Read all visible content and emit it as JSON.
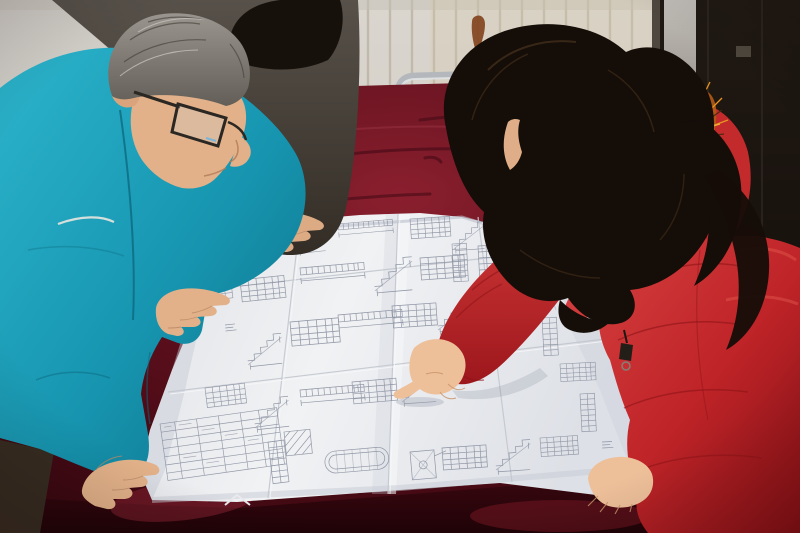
{
  "meta": {
    "type": "photograph",
    "width": 800,
    "height": 533,
    "description": "Two people review a large unfolded engineering blueprint spread over a red velvet-covered table. A middle-aged man with gray hair, dark-rimmed glasses and a bright teal work jacket leans over the drawing on the left with both hands on the sheet. A woman with long dark wavy hair, wearing a red quilted coat with an orange fur-trimmed hood, stands on the right pointing at a detail with her index finger. A third, partially visible person in a dark jacket rests one hand on the top edge of the drawing. Behind them are a ribbed cream panel wall, a dark brown door, and a metal-frame chair with a red seat."
  },
  "scene": {
    "background": {
      "wall": "ribbed cream panel wall with vertical grooves",
      "door": "dark brown door with light frame strip",
      "stain": "rust stain on wall"
    },
    "furniture": {
      "table": "table draped in dark red velvet cloth",
      "chair": "metal tube chair with red seat behind the table"
    },
    "document": {
      "blueprint": "large multi-panel structural engineering drawing with rebar schedules, stair sections, beam details, an oval section detail and visible fold creases"
    },
    "people": [
      {
        "id": "man-left",
        "description": "middle-aged man, gray hair, dark-rimmed glasses, bright teal work jacket, leaning over the drawing with both hands on it"
      },
      {
        "id": "person-behind",
        "description": "partially visible colleague in a dark jacket, black hair, one hand resting on the top edge of the drawing"
      },
      {
        "id": "woman-right",
        "description": "woman with long dark wavy hair, red quilted parka with orange fur-trimmed hood, pointing at the drawing"
      }
    ]
  },
  "colors": {
    "wall": "#d4d0c9",
    "wall_left": "#d0ccc6",
    "wall_ridge": "#b9b1a1",
    "warm_tint": "#d8c8a8",
    "door": "#16100b",
    "door_gap": "#4d473f",
    "latch": "#4e473d",
    "rust": "#7d3a12",
    "chair_red": "#a2232b",
    "chair_metal": "#b4b8bc",
    "velvet_light": "#8e2434",
    "velvet_streak_dark": "#3a0712",
    "velvet_streak_light": "#a03a4a",
    "paper_ink": "#7b8294",
    "crease": "#c3c7cf",
    "jacket_behind": "#504a42",
    "hair_behind": "#17110c",
    "teal_seam": "#0c6a80",
    "cord_white": "#e9e6df",
    "trousers": "#372c21",
    "skin_man": "#e2b189",
    "skin_behind": "#dcab83",
    "skin_woman": "#eec09a",
    "skin_shadow": "#c8946a",
    "glasses": "#2b2722",
    "hair_woman": "#150d08",
    "hair_sheen": "#50381f",
    "fur": "#b35a14",
    "fur_bright": "#e8941f",
    "fur_pale": "#f2b03a",
    "fur_dark": "#452a0e",
    "hood": "#c22a2c",
    "coat_seam": "#8e1418",
    "coat_highlight": "#ef6a5a",
    "zipper": "#241e18",
    "zipper_ring": "#857f76"
  }
}
